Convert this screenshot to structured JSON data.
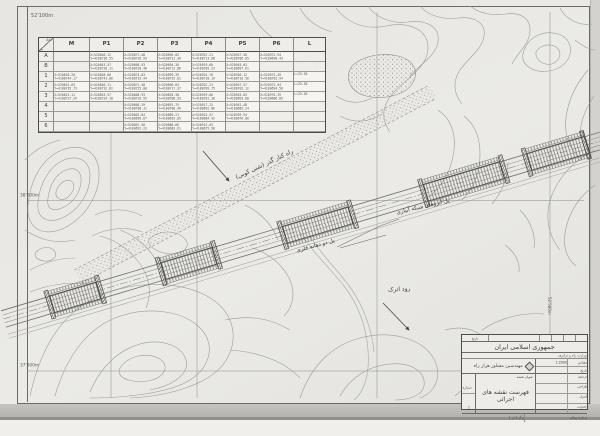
{
  "sheet": {
    "paper_color": "#e9e8e4",
    "line_color": "#8a8a86",
    "ink_color": "#45453f"
  },
  "grid_labels": {
    "top_left": "52'100m",
    "left_mid": "38'000m",
    "left_bottom": "37'800m",
    "right_vertical": "52'500m"
  },
  "annotations": {
    "bypass_road": "راه کنار گذر (شنی کوبی)",
    "culvert_bridge": "پل آبروهای شبکه آبیاری",
    "metal_bridge": "پل دو دهانه فلزی",
    "river": "رود اترک"
  },
  "coordinate_table": {
    "corner_top": "نقطه",
    "corner_bottom": "پل",
    "columns": [
      "M",
      "P1",
      "P2",
      "P3",
      "P4",
      "P5",
      "P6",
      "L"
    ],
    "rows": [
      {
        "label": "A",
        "cells": [
          null,
          "X=520846.12\nY=4180736.55",
          "X=520871.48\nY=4180728.93",
          "X=520896.85\nY=4180721.30",
          "X=520922.21\nY=4180713.68",
          "X=520947.58\nY=4180706.05",
          "X=520972.94\nY=4180698.43",
          null
        ]
      },
      {
        "label": "B",
        "cells": [
          null,
          "X=520843.57\nY=4180728.11",
          "X=520868.93\nY=4180720.48",
          "X=520894.30\nY=4180712.86",
          "X=520919.66\nY=4180705.23",
          "X=520945.03\nY=4180697.61",
          null,
          null
        ]
      },
      {
        "label": "1",
        "cells": [
          "X=520818.20\nY=4180744.17",
          "X=520848.66\nY=4180741.06",
          "X=520874.03\nY=4180733.44",
          "X=520899.39\nY=4180725.81",
          "X=520924.76\nY=4180718.19",
          "X=520950.12\nY=4180710.56",
          "X=520975.49\nY=4180702.94",
          "L=25.36"
        ]
      },
      {
        "label": "2",
        "cells": [
          "X=520815.65\nY=4180735.73",
          "X=520846.11\nY=4180732.62",
          "X=520871.48\nY=4180725.00",
          "X=520896.84\nY=4180717.37",
          "X=520922.21\nY=4180709.75",
          "X=520947.57\nY=4180702.12",
          "X=520972.94\nY=4180694.50",
          "L=25.36"
        ]
      },
      {
        "label": "3",
        "cells": [
          "X=520813.11\nY=4180727.29",
          "X=520843.57\nY=4180724.18",
          "X=520868.93\nY=4180716.55",
          "X=520894.30\nY=4180708.93",
          "X=520919.66\nY=4180701.30",
          "X=520945.03\nY=4180693.68",
          "X=520970.39\nY=4180686.05",
          "L=25.36"
        ]
      },
      {
        "label": "4",
        "cells": [
          null,
          null,
          "X=520866.39\nY=4180708.11",
          "X=520891.75\nY=4180700.49",
          "X=520917.12\nY=4180692.86",
          "X=520942.48\nY=4180685.24",
          null,
          null
        ]
      },
      {
        "label": "5",
        "cells": [
          null,
          null,
          "X=520863.84\nY=4180699.67",
          "X=520889.21\nY=4180692.05",
          "X=520914.57\nY=4180684.42",
          "X=520939.94\nY=4180676.80",
          null,
          null
        ]
      },
      {
        "label": "6",
        "cells": [
          null,
          null,
          "X=520861.30\nY=4180691.23",
          "X=520886.66\nY=4180683.61",
          "X=520912.03\nY=4180675.98",
          null,
          null,
          null
        ]
      }
    ]
  },
  "title_block": {
    "rev_label": "تاریخ",
    "nation": "جمهوری اسلامی ایران",
    "ministry": "وزارت راه و ترابری",
    "company": "مهندسین مشاور هراز راه",
    "scale_label": "مقیاس",
    "scale_value": "1:2000",
    "date_label": "تاریخ",
    "date_value": "",
    "sig_rows": [
      [
        "ترسیم",
        ""
      ],
      [
        "طراحی",
        ""
      ],
      [
        "کنترل",
        ""
      ],
      [
        "تصویب",
        ""
      ]
    ],
    "title_label": "عنوان نقشه",
    "drawing_title": "فهرست نقشه های اجرائی",
    "sheet_label": "شماره",
    "sheet_value": "1",
    "contract_label": "شماره پیمان",
    "sheet_note": "برگ 1 از 1"
  }
}
